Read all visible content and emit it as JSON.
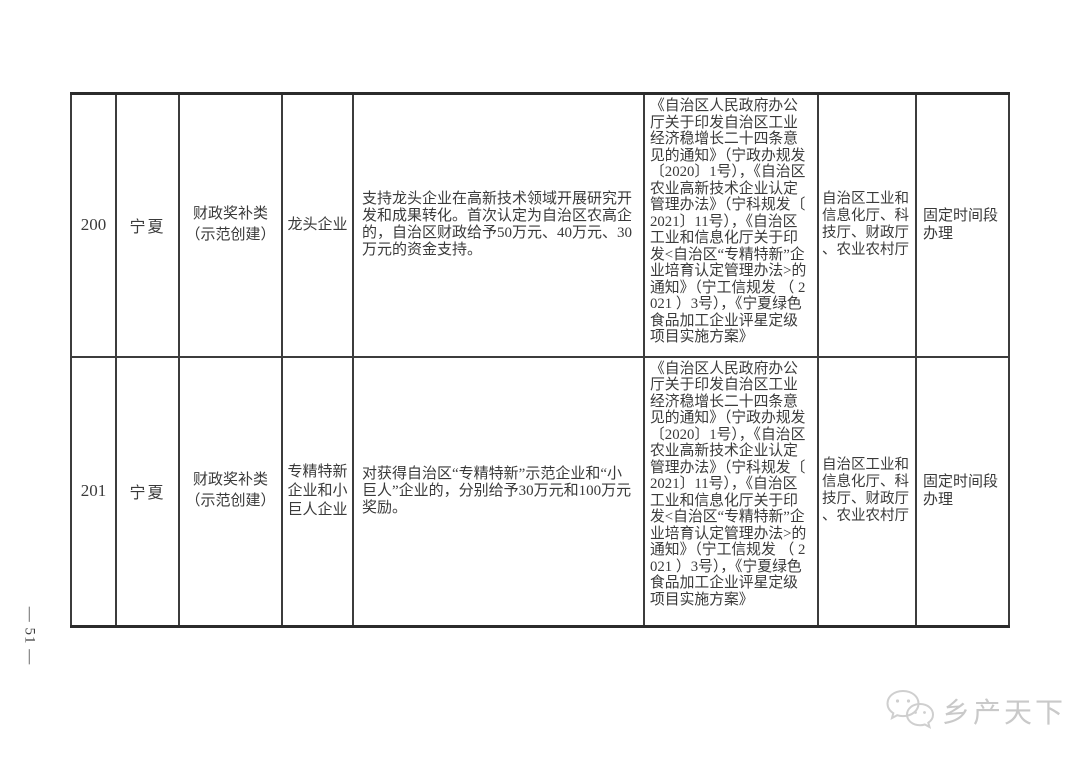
{
  "page": {
    "page_number": "— 51 —",
    "watermark_text": "乡产天下",
    "watermark_color": "#c9c9c9",
    "text_color": "#3a3a3a",
    "border_color": "#2b2b2b"
  },
  "table": {
    "rows": [
      {
        "id": "200",
        "region": "宁夏",
        "category": "财政奖补类\n（示范创建）",
        "enterprise_type": "龙头企业",
        "description": "支持龙头企业在高新技术领域开展研究开发和成果转化。首次认定为自治区农高企的，自治区财政给予50万元、40万元、30万元的资金支持。",
        "policy_basis": "《自治区人民政府办公厅关于印发自治区工业经济稳增长二十四条意见的通知》（宁政办规发〔2020〕1号），《自治区农业高新技术企业认定管理办法》（宁科规发〔2021〕11号），《自治区工业和信息化厅关于印发<自治区“专精特新”企业培育认定管理办法>的通知》（宁工信规发 （ 2021 ）3号），《宁夏绿色食品加工企业评星定级项目实施方案》",
        "departments": "自治区工业和信息化厅、科技厅、财政厅、农业农村厅",
        "handling_time": "固定时间段办理"
      },
      {
        "id": "201",
        "region": "宁夏",
        "category": "财政奖补类\n（示范创建）",
        "enterprise_type": "专精特新企业和小巨人企业",
        "description": "对获得自治区“专精特新”示范企业和“小巨人”企业的，分别给予30万元和100万元奖励。",
        "policy_basis": "《自治区人民政府办公厅关于印发自治区工业经济稳增长二十四条意见的通知》（宁政办规发〔2020〕1号），《自治区农业高新技术企业认定管理办法》（宁科规发〔2021〕11号），《自治区工业和信息化厅关于印发<自治区“专精特新”企业培育认定管理办法>的通知》（宁工信规发 （ 2021 ）3号），《宁夏绿色食品加工企业评星定级项目实施方案》",
        "departments": "自治区工业和信息化厅、科技厅、财政厅、农业农村厅",
        "handling_time": "固定时间段办理"
      }
    ]
  }
}
